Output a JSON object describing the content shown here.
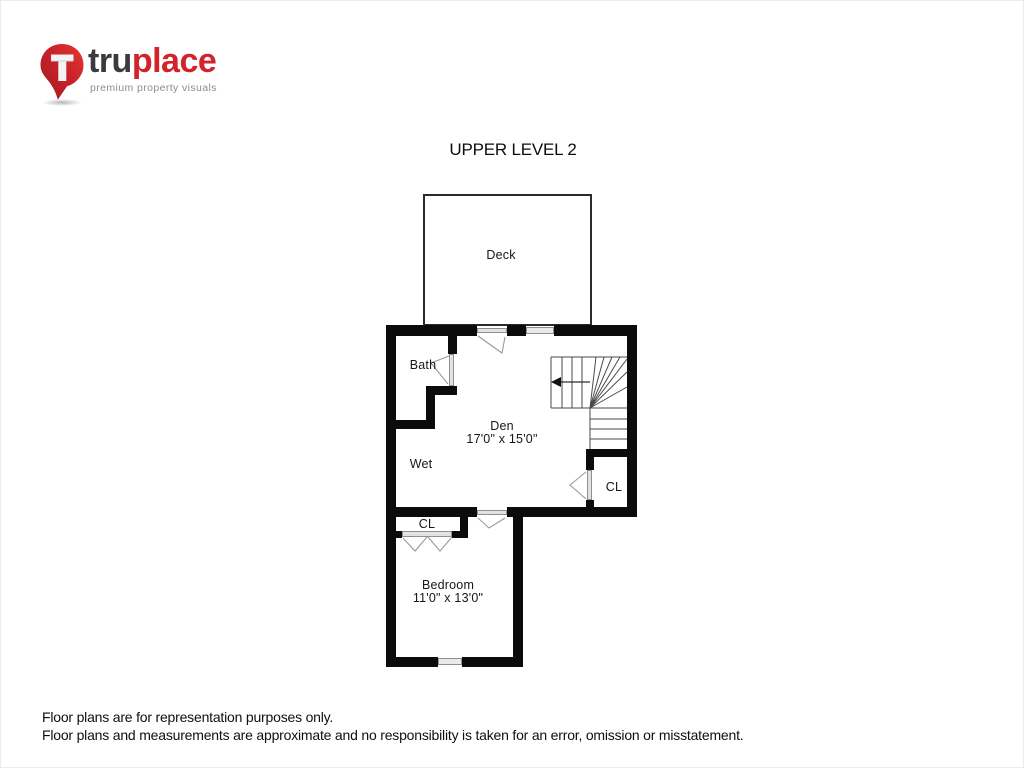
{
  "logo": {
    "brand_prefix": "tru",
    "brand_suffix": "place",
    "tagline": "premium property visuals",
    "pin_color": "#d2232a",
    "pin_color_dark": "#a51d22",
    "brand_dark_color": "#3b3b3d",
    "tagline_color": "#8c8c8c"
  },
  "title": "UPPER LEVEL 2",
  "floorplan": {
    "wall_color": "#0b0b0b",
    "stair_line_color": "#4a4a4a",
    "door_swing_color": "#999999",
    "labels": {
      "deck": "Deck",
      "bath": "Bath",
      "den_name": "Den",
      "den_dims": "17'0\" x 15'0\"",
      "wet": "Wet",
      "closet_den": "CL",
      "closet_bedroom": "CL",
      "bedroom_name": "Bedroom",
      "bedroom_dims": "11'0\" x 13'0\""
    }
  },
  "footer": {
    "line1": "Floor plans are for representation purposes only.",
    "line2": "Floor plans and measurements are approximate and no responsibility is taken for an error, omission or misstatement."
  }
}
